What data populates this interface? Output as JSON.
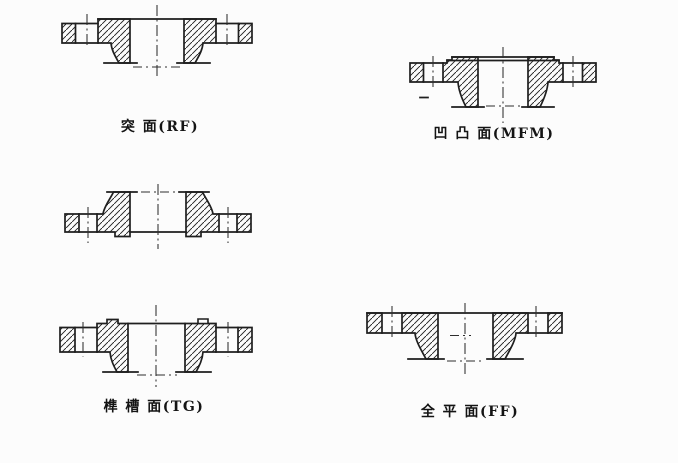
{
  "figure": {
    "background": "#fcfcfc",
    "ink": "#1f1f1f",
    "labels": {
      "rf": "突 面(RF)",
      "mfm": "凹 凸 面(MFM)",
      "tg": "榫 槽 面(TG)",
      "ff": "全 平 面(FF)"
    }
  }
}
